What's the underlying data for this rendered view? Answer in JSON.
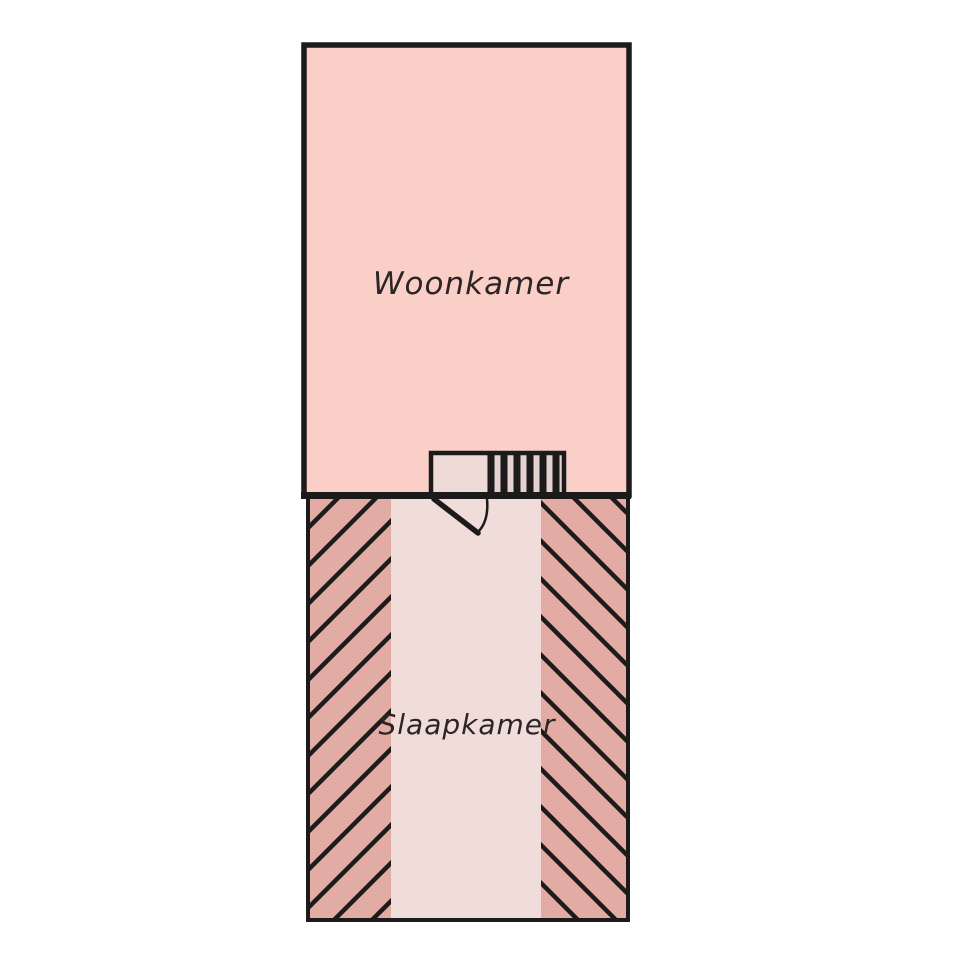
{
  "page": {
    "background": "#ffffff",
    "type_note": "hand-drawn floor plan"
  },
  "colors": {
    "line": "#1c1a1a",
    "text": "#2b2526",
    "woonkamer_fill": "#f9cfc7",
    "slaapkamer_fill": "#f0dcd8",
    "sloped_area_fill": "#e2aba3",
    "stair_landing_fill": "#eedad6",
    "stair_tread_gap_fill": "#e3d2cf",
    "white": "#ffffff"
  },
  "floor_plan": {
    "rooms": {
      "woonkamer": {
        "label": "Woonkamer"
      },
      "slaapkamer": {
        "label": "Slaapkamer"
      }
    },
    "features": {
      "stairs": "staircase",
      "door": "door-swing",
      "sloped_left": "hatched-sloped-ceiling-left",
      "sloped_right": "hatched-sloped-ceiling-right"
    }
  }
}
